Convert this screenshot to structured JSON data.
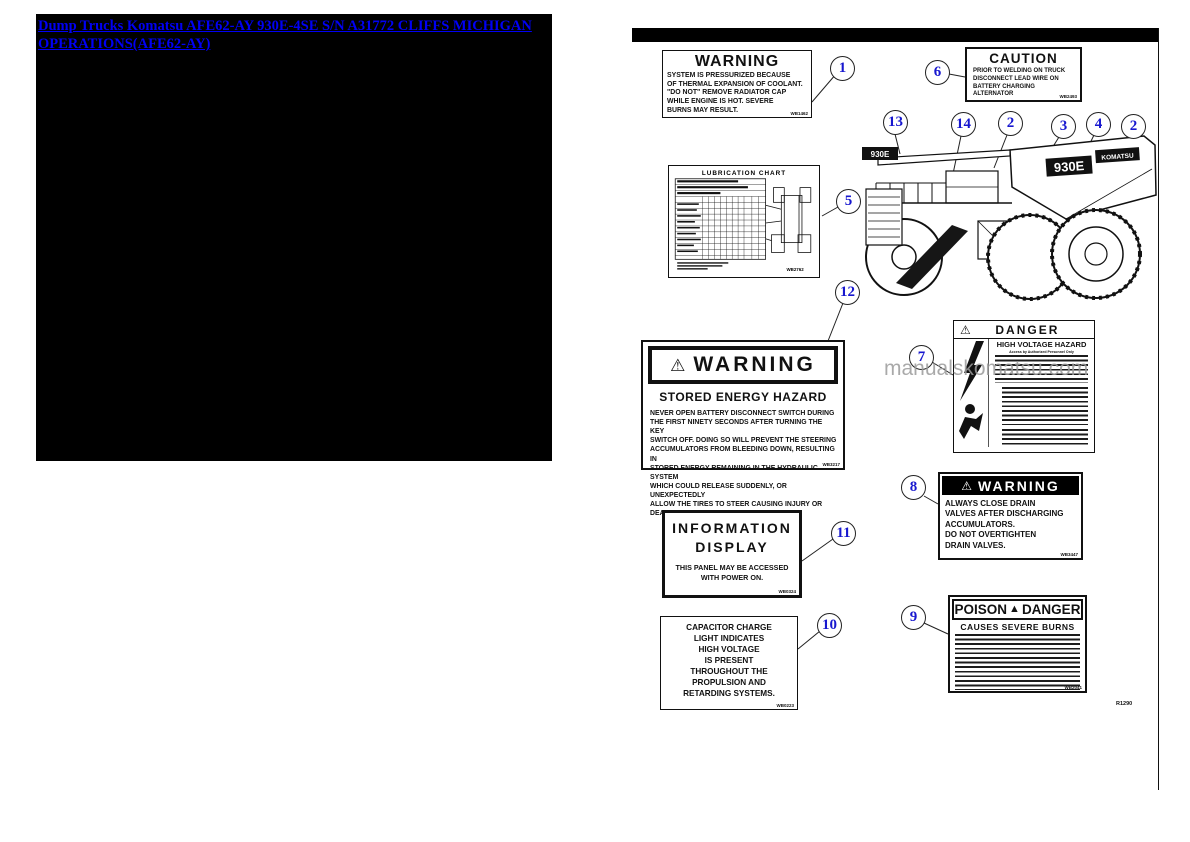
{
  "window": {
    "link_title": "Dump Trucks Komatsu AFE62-AY 930E-4SE S/N A31772 CLIFFS MICHIGAN OPERATIONS(AFE62-AY)"
  },
  "watermark": "manualskomatsu.com",
  "figure_ref": "R1290",
  "callouts": [
    "1",
    "6",
    "13",
    "14",
    "2",
    "3",
    "4",
    "2",
    "5",
    "12",
    "7",
    "8",
    "11",
    "10",
    "9"
  ],
  "labels": {
    "coolant": {
      "title": "WARNING",
      "body": "SYSTEM IS PRESSURIZED BECAUSE\nOF THERMAL EXPANSION OF COOLANT.\n\"DO NOT\" REMOVE RADIATOR CAP\nWHILE ENGINE IS HOT. SEVERE\nBURNS MAY RESULT.",
      "code": "WB1462"
    },
    "caution": {
      "title": "CAUTION",
      "body": "PRIOR TO WELDING ON TRUCK\nDISCONNECT LEAD WIRE ON\nBATTERY CHARGING ALTERNATOR",
      "code": "WB2493"
    },
    "lube_chart": {
      "title": "LUBRICATION  CHART",
      "code": "WB2762"
    },
    "stored_energy": {
      "title": "WARNING",
      "warning_symbol": "⚠",
      "subtitle": "STORED ENERGY HAZARD",
      "body": "NEVER OPEN BATTERY DISCONNECT SWITCH DURING\nTHE FIRST NINETY SECONDS AFTER TURNING THE KEY\nSWITCH OFF.  DOING SO WILL PREVENT THE STEERING\nACCUMULATORS FROM BLEEDING DOWN, RESULTING IN\nSTORED ENERGY REMAINING IN THE HYDRAULIC SYSTEM\nWHICH COULD RELEASE SUDDENLY, OR UNEXPECTEDLY\nALLOW THE TIRES TO STEER CAUSING INJURY OR DEATH.",
      "code": "WB3217"
    },
    "high_voltage": {
      "title": "DANGER",
      "warning_symbol": "⚠",
      "subtitle": "HIGH VOLTAGE HAZARD",
      "note": "Access by Authorized Personnel Only"
    },
    "drain_valves": {
      "title": "WARNING",
      "warning_symbol": "⚠",
      "body": "ALWAYS CLOSE DRAIN\nVALVES AFTER DISCHARGING\nACCUMULATORS.\nDO NOT OVERTIGHTEN\nDRAIN VALVES.",
      "code": "WB3447"
    },
    "info_display": {
      "title": "INFORMATION\nDISPLAY",
      "body": "THIS PANEL MAY BE ACCESSED\nWITH POWER ON.",
      "code": "WB0324"
    },
    "capacitor": {
      "body": "CAPACITOR CHARGE\nLIGHT INDICATES\nHIGH VOLTAGE\nIS PRESENT\nTHROUGHOUT THE\nPROPULSION AND\nRETARDING SYSTEMS.",
      "code": "WB0223"
    },
    "poison": {
      "word_left": "POISON",
      "warning_symbol": "▲",
      "word_right": "DANGER",
      "subtitle": "CAUSES SEVERE BURNS",
      "code": "WB2041"
    }
  },
  "truck": {
    "model_badge": "930E",
    "brand_badge": "KOMATSU",
    "front_badge": "930E"
  }
}
